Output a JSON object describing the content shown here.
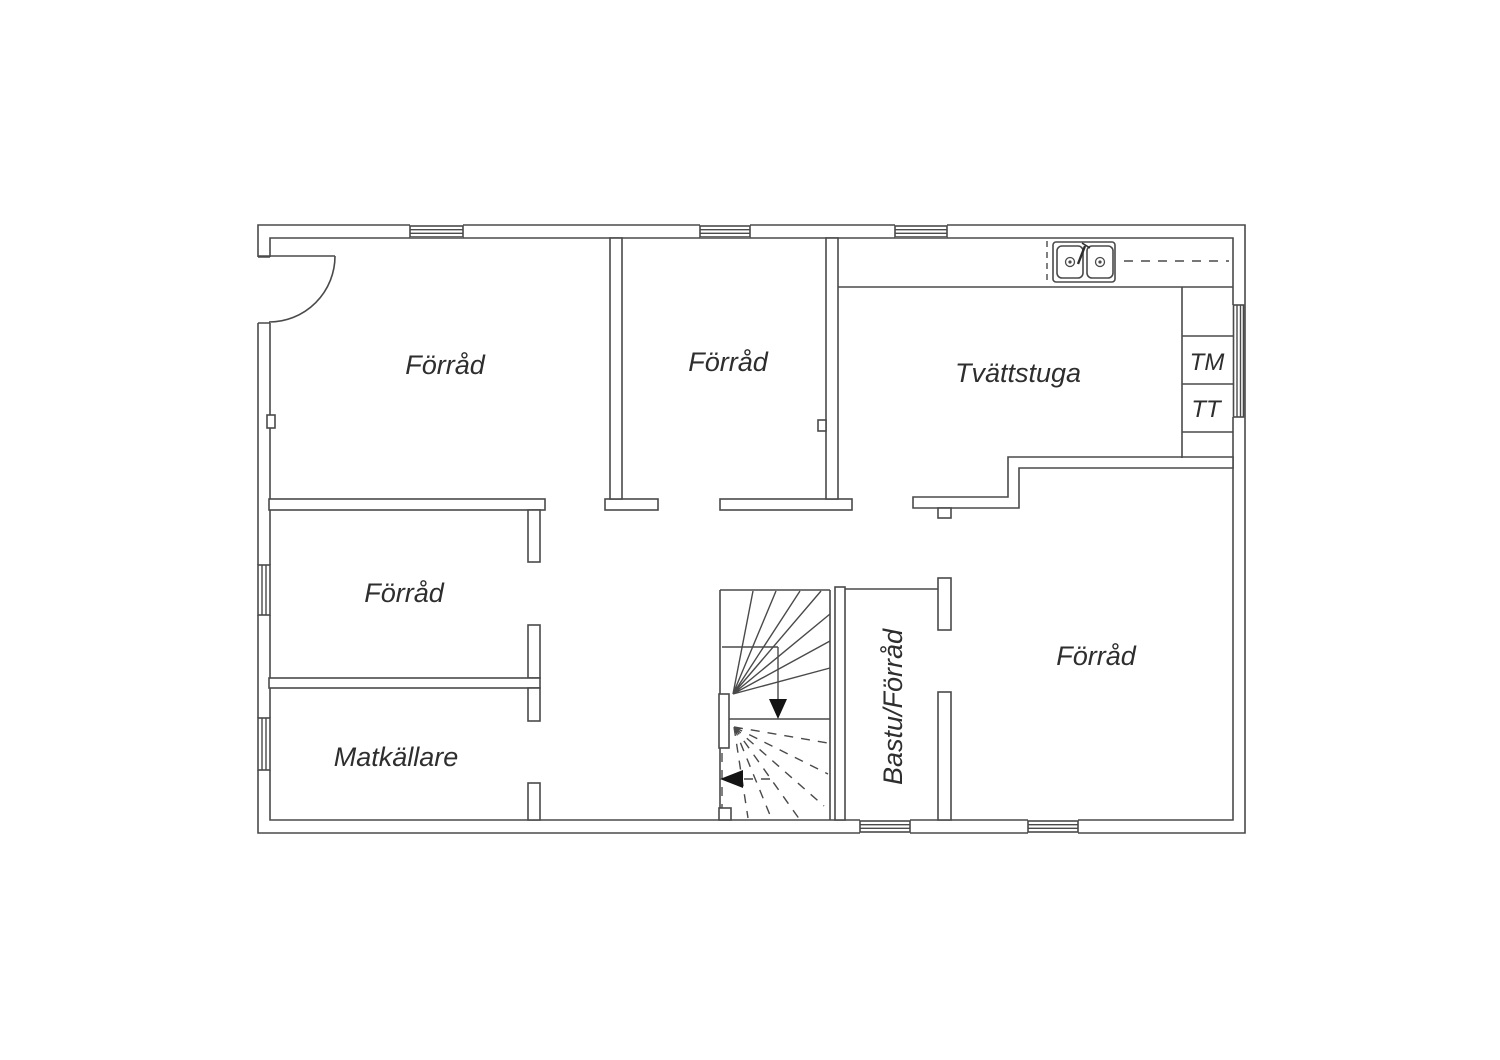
{
  "colors": {
    "background": "#ffffff",
    "wall_line": "#4a4a4a",
    "text": "#2e2e2e",
    "arrow": "#141414"
  },
  "floor_plan": {
    "rooms": [
      {
        "id": "forrad-top-left",
        "label": "Förråd"
      },
      {
        "id": "forrad-top-middle",
        "label": "Förråd"
      },
      {
        "id": "tvattstuga",
        "label": "Tvättstuga"
      },
      {
        "id": "forrad-mid-left",
        "label": "Förråd"
      },
      {
        "id": "matkallare",
        "label": "Matkällare"
      },
      {
        "id": "bastu-forrad",
        "label": "Bastu/Förråd"
      },
      {
        "id": "forrad-right",
        "label": "Förråd"
      }
    ],
    "appliances": [
      {
        "id": "washing-machine",
        "label": "TM"
      },
      {
        "id": "tumble-dryer",
        "label": "TT"
      }
    ],
    "features": [
      "entrance-door-arc",
      "winder-staircase",
      "double-basin-sink",
      "counter-dashed-line",
      "windows"
    ]
  }
}
